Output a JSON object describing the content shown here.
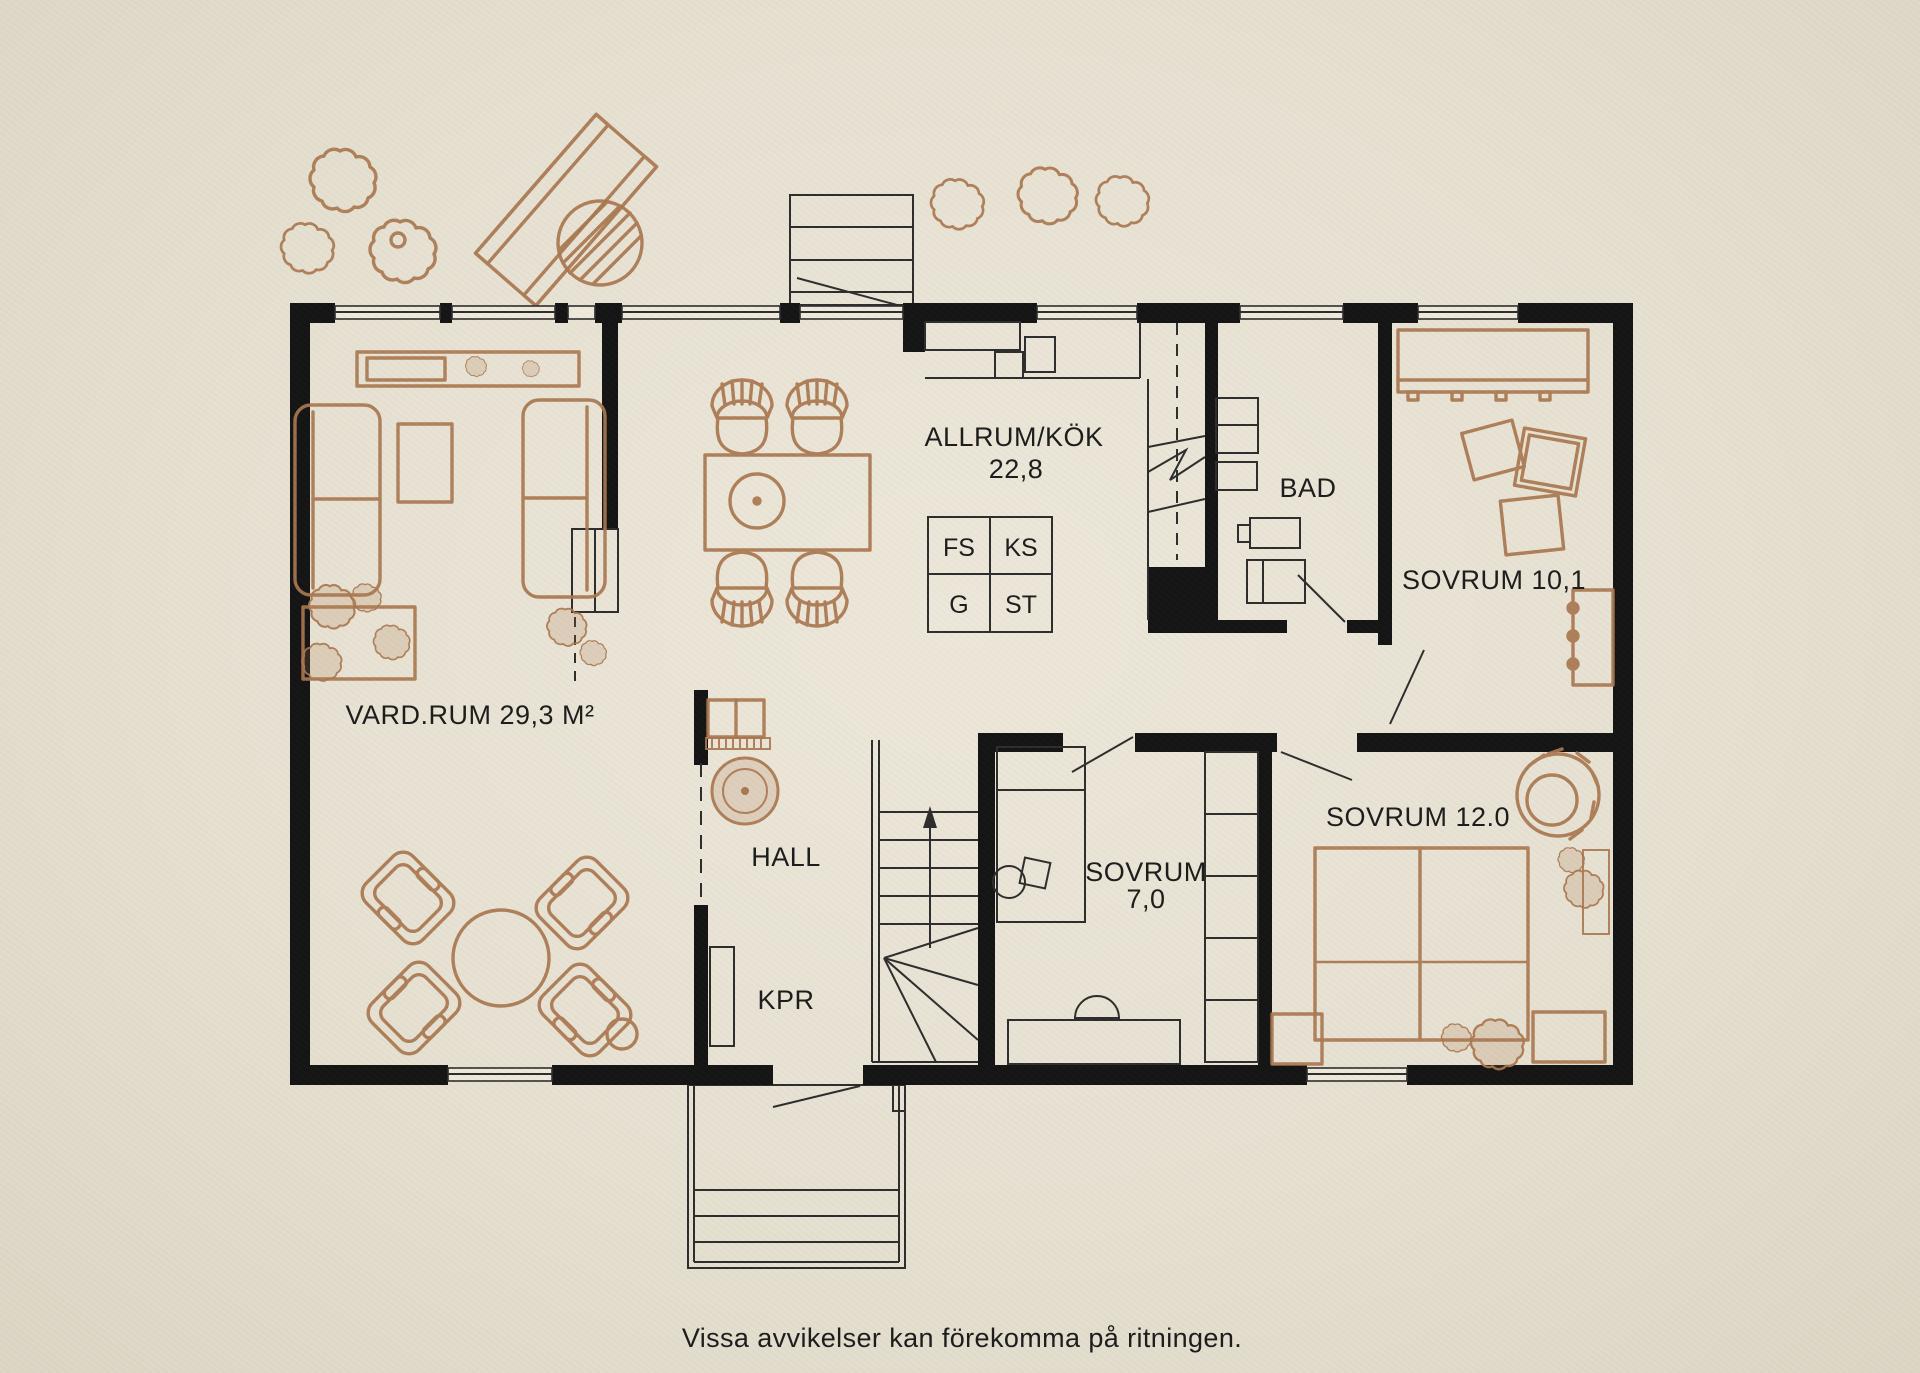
{
  "colors": {
    "paper": "#e6e0d1",
    "wall": "#121212",
    "line": "#2b2b2b",
    "sketch": "#a8764e",
    "text": "#1a1a1a"
  },
  "rooms": [
    {
      "id": "vardagsrum",
      "label": "VARD.RUM 29,3 M²"
    },
    {
      "id": "allrum-kok",
      "label": "ALLRUM/KÖK",
      "area": "22,8"
    },
    {
      "id": "bad",
      "label": "BAD"
    },
    {
      "id": "sovrum-10",
      "label": "SOVRUM 10,1"
    },
    {
      "id": "sovrum-7",
      "label": "SOVRUM",
      "area": "7,0"
    },
    {
      "id": "sovrum-12",
      "label": "SOVRUM 12.0"
    },
    {
      "id": "hall",
      "label": "HALL"
    },
    {
      "id": "kpr",
      "label": "KPR"
    }
  ],
  "appliances": [
    {
      "id": "fs",
      "label": "FS"
    },
    {
      "id": "ks",
      "label": "KS"
    },
    {
      "id": "g",
      "label": "G"
    },
    {
      "id": "st",
      "label": "ST"
    }
  ],
  "caption": "Vissa avvikelser kan förekomma på ritningen."
}
